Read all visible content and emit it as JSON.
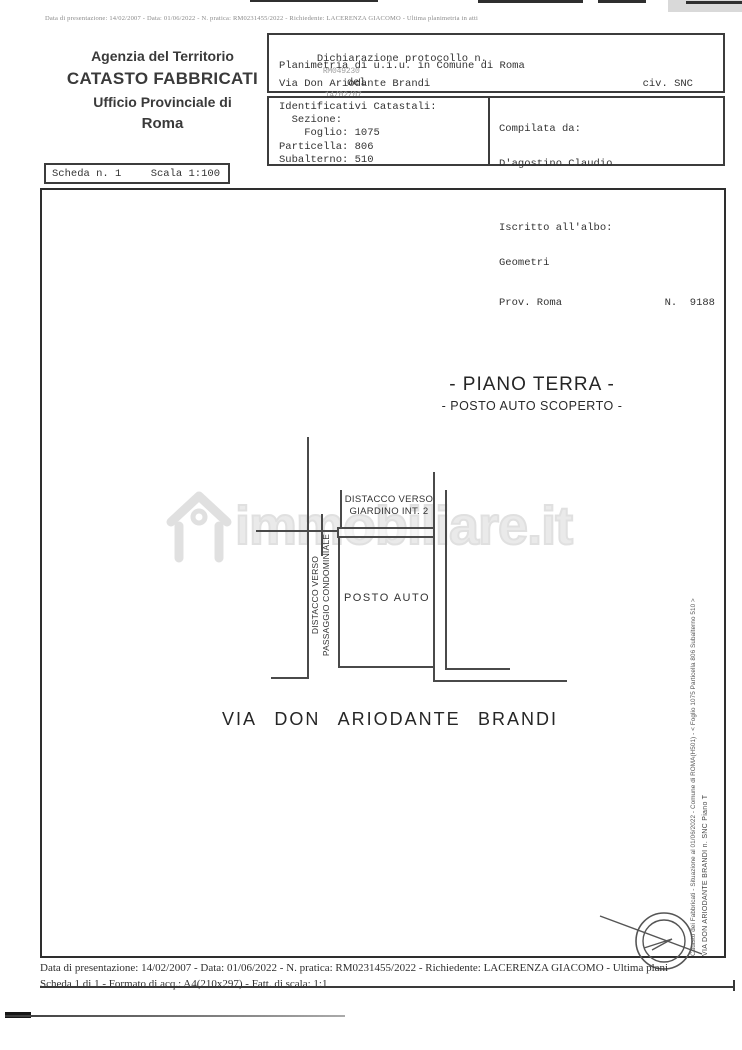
{
  "page": {
    "top_note": "Data di presentazione: 14/02/2007 - Data: 01/06/2022 - N. pratica: RM0231455/2022 - Richiedente: LACERENZA GIACOMO - Ultima planimetria in atti"
  },
  "agency": {
    "line1": "Agenzia del Territorio",
    "line2": "CATASTO FABBRICATI",
    "line3": "Ufficio Provinciale di",
    "line4": "Roma"
  },
  "declaration": {
    "label": "Dichiarazione protocollo n.",
    "protocol_number": "RM049230",
    "del_label": "del",
    "protocol_date": "14/02/07",
    "line2": "Planimetria di u.i.u. in Comune di Roma",
    "street": "Via Don Ariodante Brandi",
    "civic": "civ. SNC"
  },
  "cadastral": {
    "title": "Identificativi Catastali:",
    "sezione": "  Sezione:",
    "foglio": "    Foglio: 1075",
    "particella": "Particella: 806",
    "subalterno": "Subalterno: 510"
  },
  "compiler": {
    "label": "Compilata da:",
    "name": "D'agostino Claudio",
    "register_label": "Iscritto all'albo:",
    "register": "Geometri",
    "prov": "Prov. Roma",
    "number": "N.  9188"
  },
  "sheet": {
    "scheda": "Scheda n. 1",
    "scala": "Scala 1:100"
  },
  "plan": {
    "title": "- PIANO TERRA -",
    "subtitle": "- POSTO AUTO SCOPERTO -",
    "giardino_label_1": "DISTACCO VERSO",
    "giardino_label_2": "GIARDINO INT. 2",
    "passaggio_label_1": "DISTACCO VERSO",
    "passaggio_label_2": "PASSAGGIO CONDOMINIALE",
    "posto_auto_label": "POSTO AUTO",
    "street_words": [
      "VIA",
      "DON",
      "ARIODANTE",
      "BRANDI"
    ]
  },
  "watermark": {
    "text": "immobiliare.it"
  },
  "side_notes": {
    "line1": "Catasto dei Fabbricati - Situazione al 01/06/2022 - Comune di ROMA(H501) - < Foglio 1075 Particella 806 Subalterno 510 >",
    "line2": "VIA DON ARIODANTE BRANDI n. SNC Piano T"
  },
  "footer": {
    "line1": "Data di presentazione: 14/02/2007 - Data: 01/06/2022 - N. pratica: RM0231455/2022 - Richiedente: LACERENZA GIACOMO - Ultima plani",
    "line2": "Scheda 1 di 1 - Formato di acq.: A4(210x297) - Fatt. di scala: 1:1"
  },
  "colors": {
    "ink": "#2b2b2b",
    "line": "#4a4a4a",
    "watermark": "#e4e4e4"
  }
}
